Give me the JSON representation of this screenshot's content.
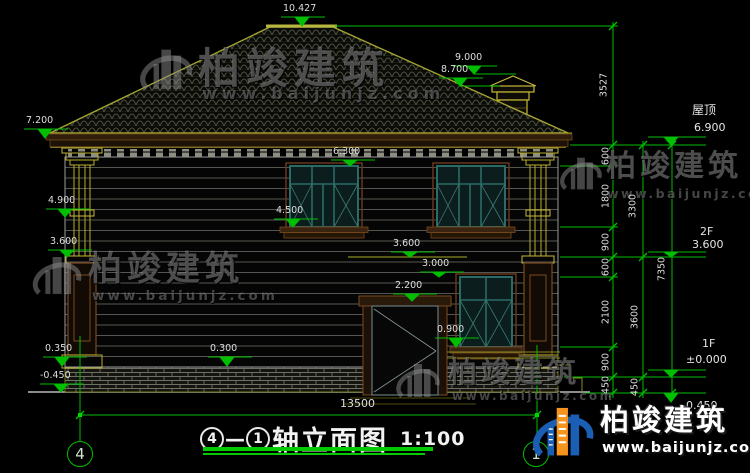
{
  "drawing": {
    "title_axis_start": "4",
    "title_dash": "—",
    "title_axis_end": "1",
    "title_text": "轴立面图",
    "title_scale": "1:100"
  },
  "grid_bubbles": {
    "left": "4",
    "right": "1"
  },
  "flags": {
    "ridge": "10.427",
    "chimney_top": "9.000",
    "chimney_cap": "8.700",
    "eave_left": "7.200",
    "win_head_2f": "6.300",
    "column_cap": "4.900",
    "win_sill_2f": "4.500",
    "belt_left": "3.600",
    "belt_mid": "3.600",
    "win_head_1f": "3.000",
    "door_head": "2.200",
    "win_sill_1f": "0.900",
    "plinth_left": "0.350",
    "ground_left": "-0.450",
    "plinth_mid": "0.300"
  },
  "chain": {
    "c3527": "3527",
    "c600a": "600",
    "c1800": "1800",
    "c3300": "3300",
    "c900a": "900",
    "c600b": "600",
    "c2100": "2100",
    "c3600": "3600",
    "c7350": "7350",
    "c900b": "900",
    "c450a": "450",
    "c450b": "450",
    "total_width": "13500"
  },
  "right_labels": {
    "roof_label": "屋顶",
    "roof_level": "6.900",
    "f2": "2F",
    "f2_level": "3.600",
    "f1": "1F",
    "f1_level": "±0.000",
    "base_level": "-0.450"
  },
  "watermark": {
    "cn": "柏竣建筑",
    "url": "www.baijunjz.com"
  },
  "palette": {
    "dimension_green": "#00be00",
    "structure_yellow": "#b9ad2c",
    "window_teal": "#2a6b66",
    "trim_brown": "#6b3a1f",
    "logo_blue": "#1b5fb5",
    "logo_orange": "#f7941e"
  }
}
